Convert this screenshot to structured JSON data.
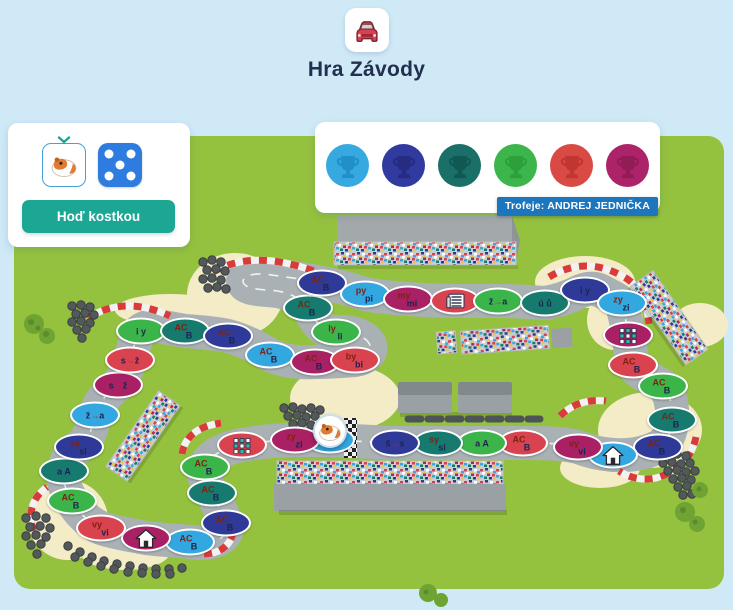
{
  "header": {
    "title": "Hra Závody"
  },
  "player_panel": {
    "roll_button_label": "Hoď kostkou",
    "dice_value": 5,
    "piece": "hamster"
  },
  "trophies": {
    "badge_label": "Trofeje: ANDREJ JEDNIČKA",
    "items": [
      {
        "color": "#36a9e1",
        "shade": "#2290c8"
      },
      {
        "color": "#313a9e",
        "shade": "#252c82"
      },
      {
        "color": "#1a6f68",
        "shade": "#0f5952"
      },
      {
        "color": "#3cb54b",
        "shade": "#2da03c"
      },
      {
        "color": "#d94a44",
        "shade": "#c23632"
      },
      {
        "color": "#ad2369",
        "shade": "#931b56"
      }
    ]
  },
  "board": {
    "palette": {
      "lblue": "#33a7e0",
      "magenta": "#a92064",
      "red": "#d8434f",
      "green": "#3bb54a",
      "teal": "#177a6f",
      "dblue": "#2f3a98"
    },
    "spaces": [
      {
        "x": 330,
        "y": 440,
        "c": "lblue",
        "line": "→ž",
        "start": true
      },
      {
        "x": 295,
        "y": 440,
        "c": "magenta",
        "t": "zy",
        "b": "zi"
      },
      {
        "x": 242,
        "y": 445,
        "c": "red",
        "icon": "grid-icon"
      },
      {
        "x": 205,
        "y": 467,
        "c": "green",
        "t": "AC",
        "b": "B"
      },
      {
        "x": 212,
        "y": 493,
        "c": "teal",
        "t": "AC",
        "b": "B"
      },
      {
        "x": 226,
        "y": 523,
        "c": "dblue",
        "t": "AC",
        "b": "B"
      },
      {
        "x": 190,
        "y": 542,
        "c": "lblue",
        "t": "AC",
        "b": "B"
      },
      {
        "x": 146,
        "y": 538,
        "c": "magenta",
        "icon": "house-icon"
      },
      {
        "x": 101,
        "y": 528,
        "c": "red",
        "t": "vy",
        "b": "vi"
      },
      {
        "x": 72,
        "y": 501,
        "c": "green",
        "t": "AC",
        "b": "B"
      },
      {
        "x": 64,
        "y": 471,
        "c": "teal",
        "line": "a A"
      },
      {
        "x": 79,
        "y": 447,
        "c": "dblue",
        "t": "sy",
        "b": "si"
      },
      {
        "x": 95,
        "y": 415,
        "c": "lblue",
        "line": "ž→a"
      },
      {
        "x": 118,
        "y": 385,
        "c": "magenta",
        "line": "s→ž"
      },
      {
        "x": 130,
        "y": 360,
        "c": "red",
        "line": "s→ž"
      },
      {
        "x": 141,
        "y": 331,
        "c": "green",
        "line": "i y"
      },
      {
        "x": 185,
        "y": 331,
        "c": "teal",
        "t": "AC",
        "b": "B"
      },
      {
        "x": 228,
        "y": 336,
        "c": "dblue",
        "t": "AC",
        "b": "B"
      },
      {
        "x": 270,
        "y": 355,
        "c": "lblue",
        "t": "AC",
        "b": "B"
      },
      {
        "x": 315,
        "y": 362,
        "c": "magenta",
        "t": "AC",
        "b": "B"
      },
      {
        "x": 355,
        "y": 360,
        "c": "red",
        "t": "by",
        "b": "bi"
      },
      {
        "x": 336,
        "y": 332,
        "c": "green",
        "t": "ly",
        "b": "li"
      },
      {
        "x": 308,
        "y": 308,
        "c": "teal",
        "t": "AC",
        "b": "B"
      },
      {
        "x": 322,
        "y": 283,
        "c": "dblue",
        "t": "AC",
        "b": "B"
      },
      {
        "x": 365,
        "y": 294,
        "c": "lblue",
        "t": "py",
        "b": "pi"
      },
      {
        "x": 408,
        "y": 299,
        "c": "magenta",
        "t": "my",
        "b": "mi"
      },
      {
        "x": 455,
        "y": 301,
        "c": "red",
        "icon": "news-icon"
      },
      {
        "x": 498,
        "y": 301,
        "c": "green",
        "line": "ž→a"
      },
      {
        "x": 545,
        "y": 303,
        "c": "teal",
        "line": "ú ů"
      },
      {
        "x": 585,
        "y": 290,
        "c": "dblue",
        "line": "i y"
      },
      {
        "x": 622,
        "y": 303,
        "c": "lblue",
        "t": "zy",
        "b": "zi"
      },
      {
        "x": 628,
        "y": 335,
        "c": "magenta",
        "icon": "grid-icon"
      },
      {
        "x": 633,
        "y": 365,
        "c": "red",
        "t": "AC",
        "b": "B"
      },
      {
        "x": 663,
        "y": 386,
        "c": "green",
        "t": "AC",
        "b": "B"
      },
      {
        "x": 672,
        "y": 420,
        "c": "teal",
        "t": "AC",
        "b": "B"
      },
      {
        "x": 658,
        "y": 447,
        "c": "dblue",
        "t": "AC",
        "b": "B"
      },
      {
        "x": 613,
        "y": 455,
        "c": "lblue",
        "icon": "house-icon"
      },
      {
        "x": 578,
        "y": 447,
        "c": "magenta",
        "t": "vy",
        "b": "vi"
      },
      {
        "x": 523,
        "y": 443,
        "c": "red",
        "t": "AC",
        "b": "B"
      },
      {
        "x": 482,
        "y": 443,
        "c": "green",
        "line": "a A"
      },
      {
        "x": 438,
        "y": 443,
        "c": "teal",
        "t": "sy",
        "b": "si"
      },
      {
        "x": 395,
        "y": 443,
        "c": "dblue",
        "line": "š→s"
      }
    ]
  }
}
